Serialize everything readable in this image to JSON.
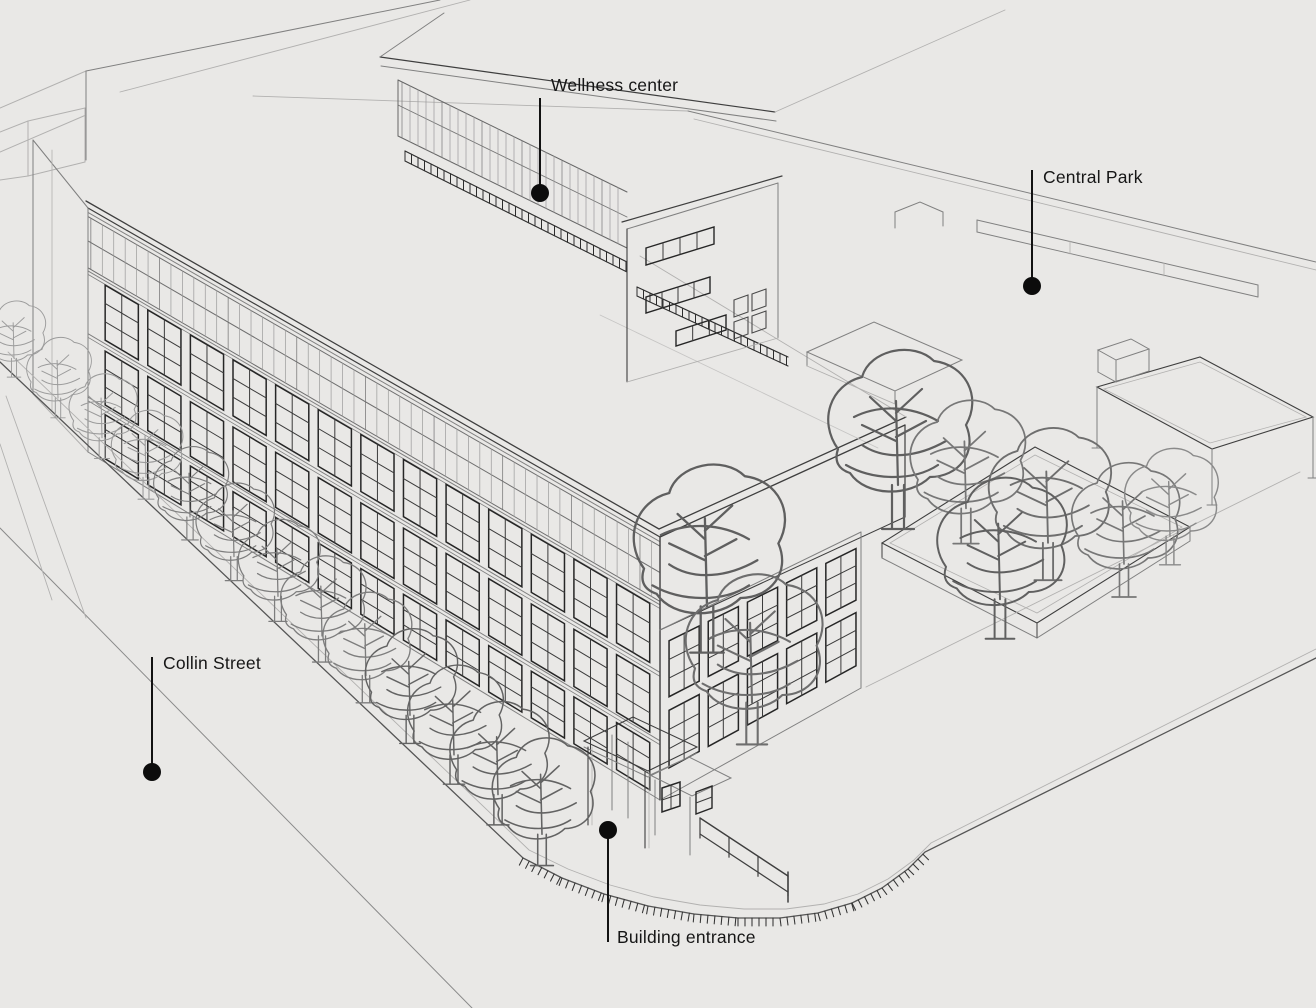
{
  "annotations": [
    {
      "id": "wellness-center",
      "label": "Wellness center"
    },
    {
      "id": "central-park",
      "label": "Central Park"
    },
    {
      "id": "collin-street",
      "label": "Collin Street"
    },
    {
      "id": "building-entrance",
      "label": "Building entrance"
    }
  ],
  "colors": {
    "background": "#e9e8e6",
    "line_dark": "#3e3e3e",
    "line_medium": "#808080",
    "line_light": "#b2b1b0",
    "marker": "#0c0c0c",
    "label_text": "#161616"
  }
}
